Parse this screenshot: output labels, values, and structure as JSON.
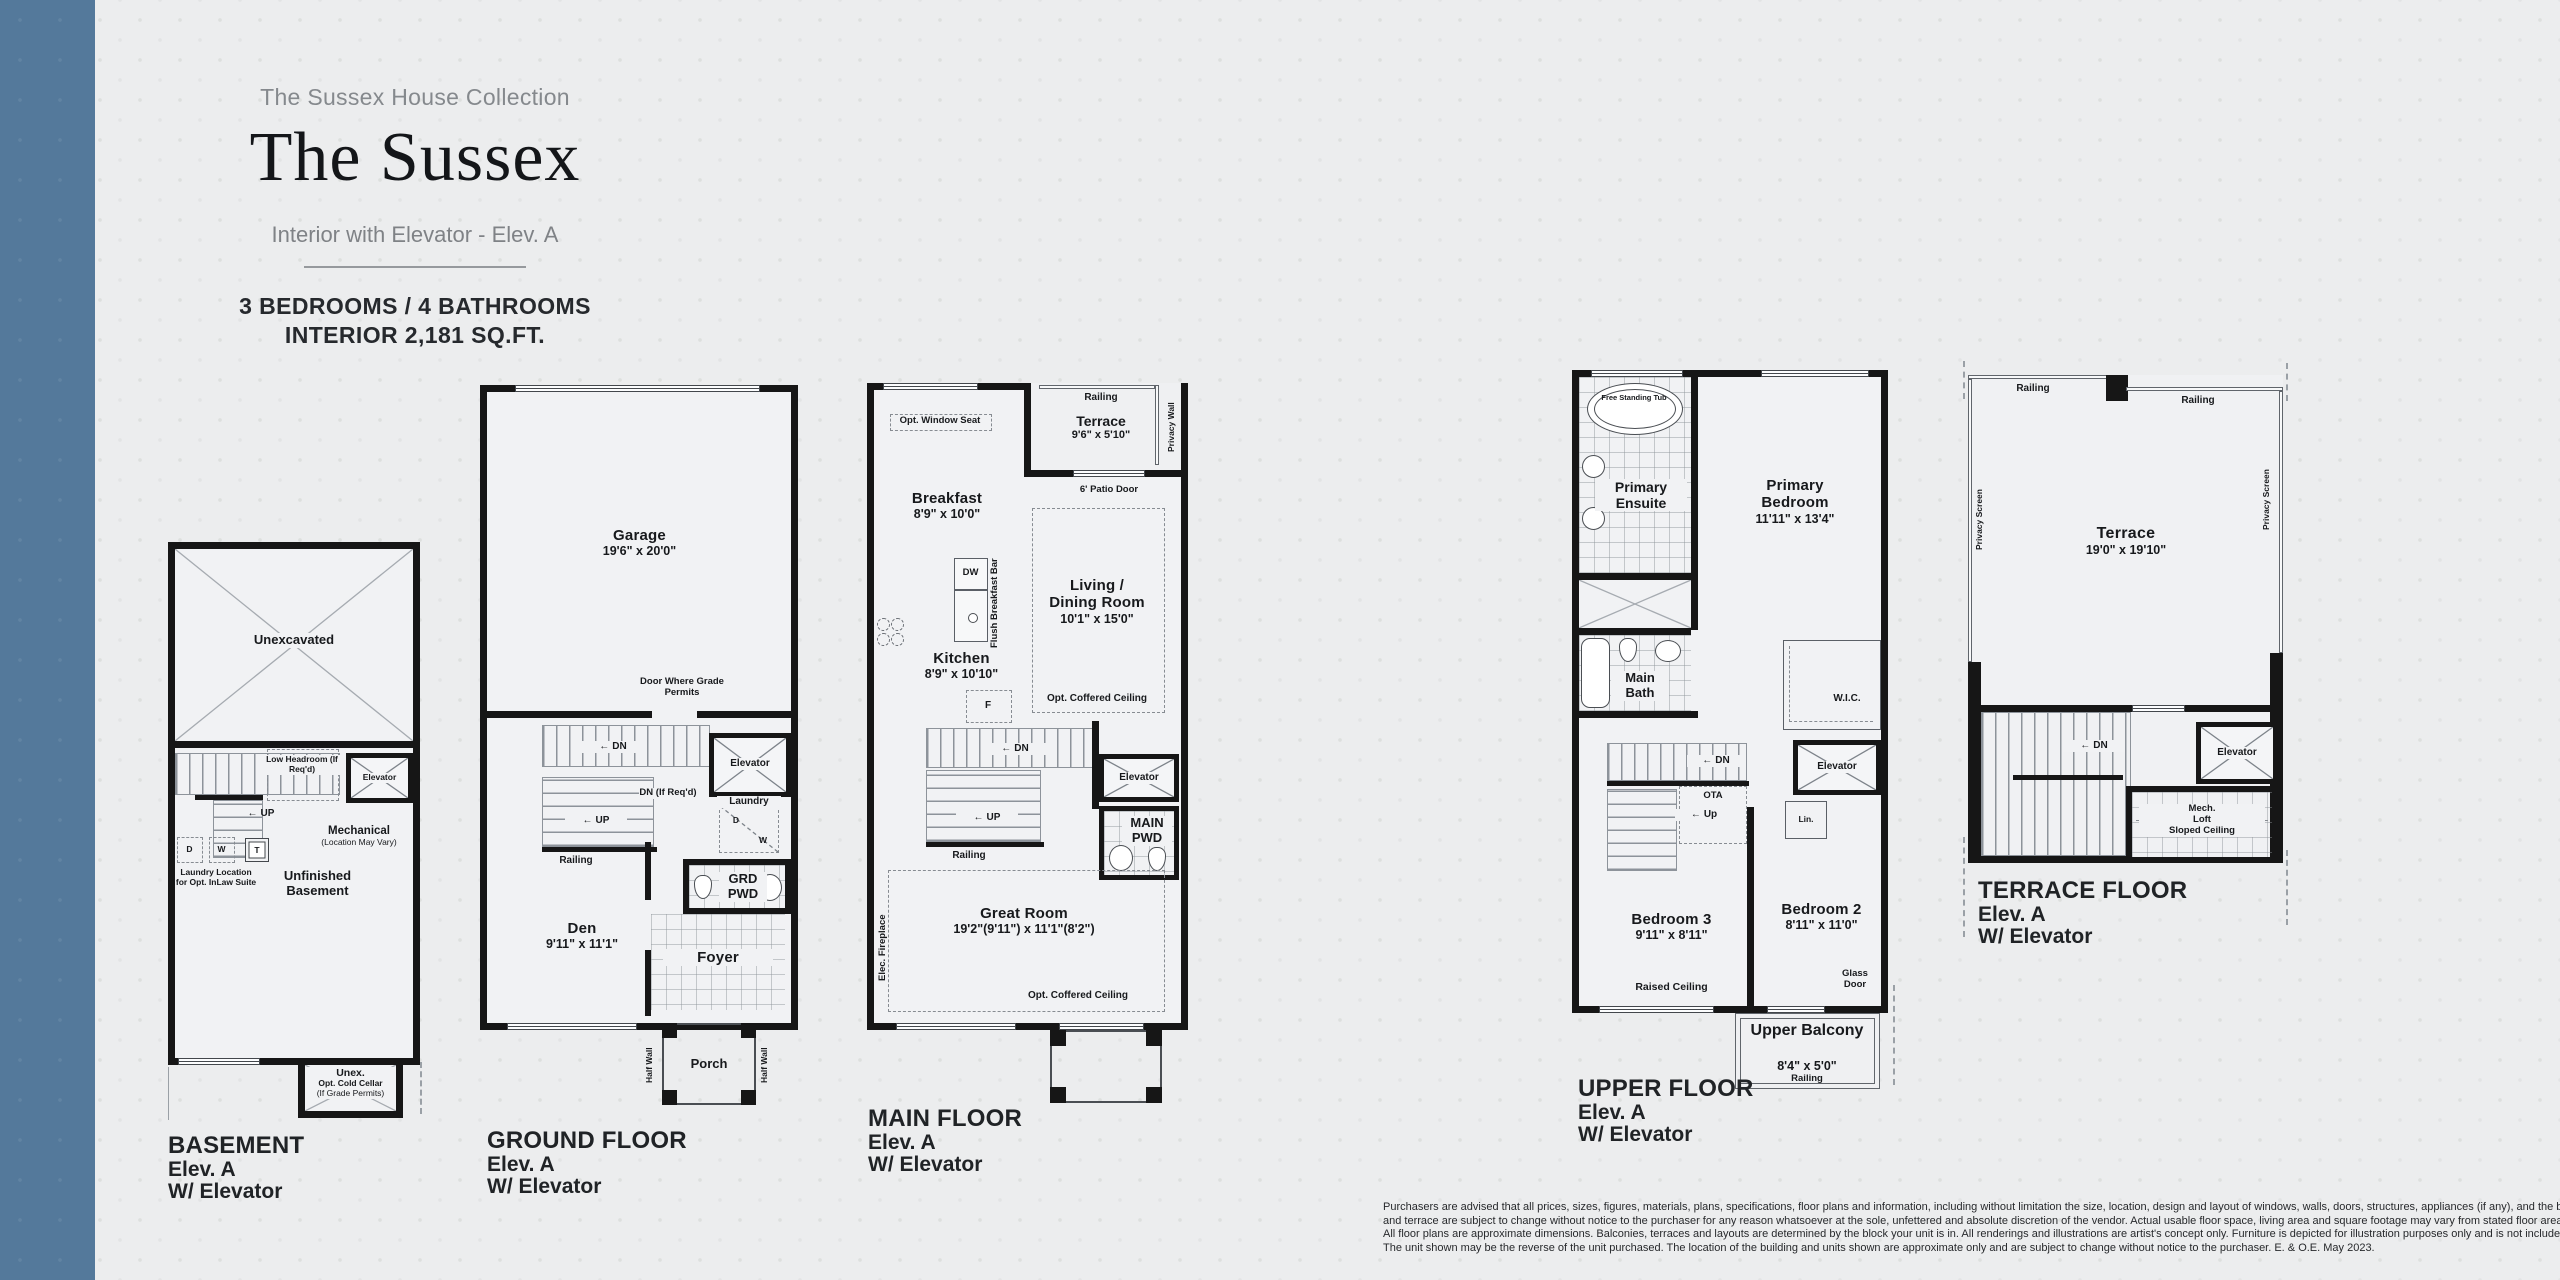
{
  "page": {
    "background": "#ecedee",
    "accent_bar_color": "#54799b",
    "wall_color": "#161616"
  },
  "glyphs": {
    "arrow_left": "←"
  },
  "header": {
    "collection": "The Sussex House Collection",
    "name": "The Sussex",
    "subtitle": "Interior with Elevator - Elev. A",
    "spec_line1": "3 BEDROOMS / 4 BATHROOMS",
    "spec_line2": "INTERIOR 2,181 SQ.FT."
  },
  "plans": {
    "basement": {
      "label": {
        "title": "BASEMENT",
        "line2": "Elev. A",
        "line3": "W/ Elevator"
      },
      "texts": {
        "unexcavated": "Unexcavated",
        "low_headroom": "Low Headroom (If Req'd)",
        "elevator": "Elevator",
        "up": "UP",
        "mechanical": "Mechanical",
        "mechanical_note": "(Location May Vary)",
        "d": "D",
        "w": "W",
        "t": "T",
        "laundry_note": "Laundry Location for Opt. InLaw Suite",
        "unfinished": "Unfinished Basement",
        "unex": "Unex.",
        "cold_cellar": "Opt. Cold Cellar",
        "cold_cellar_note": "(If Grade Permits)"
      }
    },
    "ground": {
      "label": {
        "title": "GROUND FLOOR",
        "line2": "Elev. A",
        "line3": "W/ Elevator"
      },
      "texts": {
        "garage": "Garage",
        "garage_dim": "19'6\" x 20'0\"",
        "door_grade": "Door Where Grade Permits",
        "dn": "DN",
        "dn_req": "DN (If Req'd)",
        "up": "UP",
        "railing": "Railing",
        "elevator": "Elevator",
        "laundry": "Laundry",
        "d": "D",
        "w": "W",
        "grd_pwd": "GRD PWD",
        "den": "Den",
        "den_dim": "9'11\" x 11'1\"",
        "foyer": "Foyer",
        "porch": "Porch",
        "half_wall_left": "Half Wall",
        "half_wall_right": "Half Wall"
      }
    },
    "main": {
      "label": {
        "title": "MAIN FLOOR",
        "line2": "Elev. A",
        "line3": "W/ Elevator"
      },
      "texts": {
        "railing_top": "Railing",
        "terrace": "Terrace",
        "terrace_dim": "9'6\" x 5'10\"",
        "privacy_wall": "Privacy Wall",
        "opt_window_seat": "Opt. Window Seat",
        "breakfast": "Breakfast",
        "breakfast_dim": "8'9\" x 10'0\"",
        "patio_door": "6' Patio Door",
        "dw": "DW",
        "flush_bar": "Flush Breakfast Bar",
        "kitchen": "Kitchen",
        "kitchen_dim": "8'9\" x 10'10\"",
        "f": "F",
        "living1": "Living /",
        "living2": "Dining Room",
        "living_dim": "10'1\" x 15'0\"",
        "coffered_upper": "Opt. Coffered Ceiling",
        "dn": "DN",
        "up": "UP",
        "railing": "Railing",
        "elevator": "Elevator",
        "main_pwd": "MAIN PWD",
        "great_room": "Great Room",
        "great_room_dim": "19'2\"(9'11\") x 11'1\"(8'2\")",
        "fireplace": "Elec. Fireplace",
        "coffered_lower": "Opt. Coffered Ceiling"
      }
    },
    "upper": {
      "label": {
        "title": "UPPER FLOOR",
        "line2": "Elev. A",
        "line3": "W/ Elevator"
      },
      "texts": {
        "tub": "Free Standing Tub",
        "ensuite": "Primary Ensuite",
        "bedroom1": "Primary Bedroom",
        "bedroom1_dim": "11'11\" x 13'4\"",
        "main_bath": "Main Bath",
        "wic": "W.I.C.",
        "dn": "DN",
        "ota": "OTA",
        "up": "Up",
        "elevator": "Elevator",
        "lin": "Lin.",
        "bedroom3": "Bedroom 3",
        "bedroom3_dim": "9'11\" x 8'11\"",
        "raised_ceiling": "Raised Ceiling",
        "bedroom2": "Bedroom 2",
        "bedroom2_dim": "8'11\" x 11'0\"",
        "glass_door": "Glass Door",
        "balcony": "Upper Balcony",
        "balcony_dim": "8'4\" x 5'0\"",
        "balcony_railing": "Railing"
      }
    },
    "terrace": {
      "label": {
        "title": "TERRACE FLOOR",
        "line2": "Elev. A",
        "line3": "W/ Elevator"
      },
      "texts": {
        "railing_left": "Railing",
        "railing_right": "Railing",
        "privacy_left": "Privacy Screen",
        "privacy_right": "Privacy Screen",
        "terrace": "Terrace",
        "terrace_dim": "19'0\" x 19'10\"",
        "dn": "DN",
        "elevator": "Elevator",
        "mech1": "Mech.",
        "mech2": "Loft",
        "mech3": "Sloped Ceiling"
      }
    }
  },
  "disclaimer": {
    "line1": "Purchasers are advised that all prices, sizes, figures, materials, plans, specifications, floor plans and information, including without limitation the size, location, design and layout of windows, walls, doors, structures, appliances (if any), and the balcony",
    "line2": "and terrace are subject to change without notice to the purchaser for any reason whatsoever at the sole, unfettered and absolute discretion of the vendor. Actual usable floor space, living area and square footage may vary from stated floor area.",
    "line3": "All floor plans are approximate dimensions. Balconies, terraces and layouts are determined by the block your unit is in. All renderings and illustrations are artist's concept only. Furniture is depicted for illustration purposes only and is not included.",
    "line4": "The unit shown may be the reverse of the unit purchased. The location of the building and units shown are approximate only and are subject to change without notice to the purchaser. E. & O.E. May 2023."
  }
}
